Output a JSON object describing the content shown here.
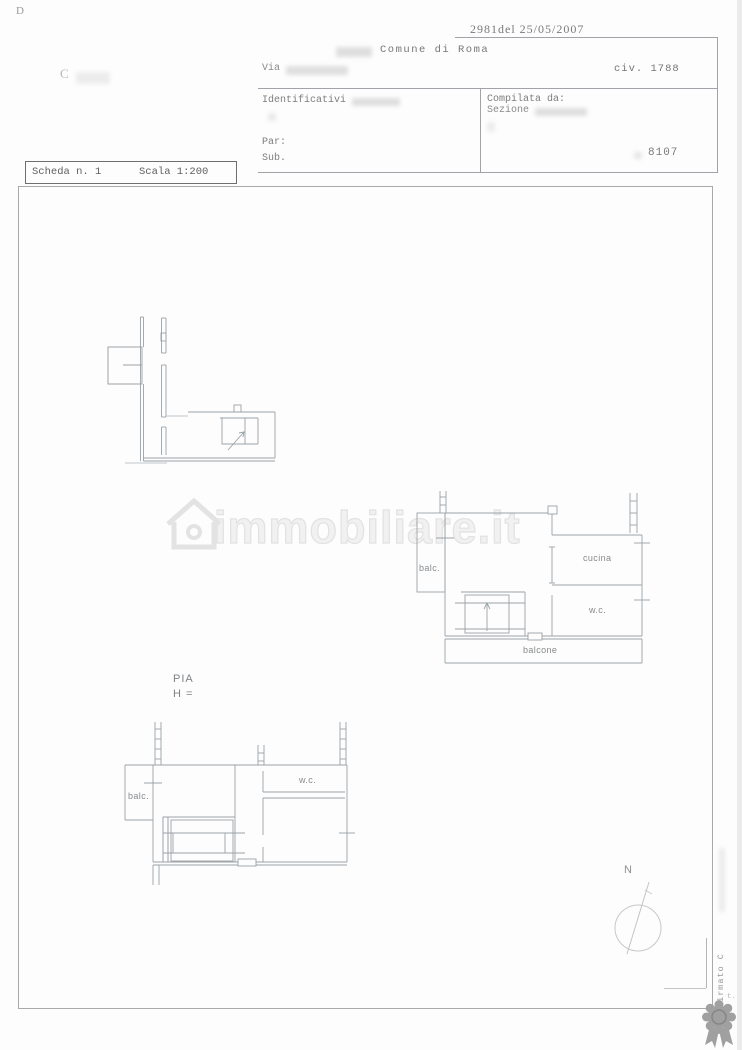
{
  "header": {
    "corner_mark": "D",
    "logo_fragment": "C",
    "protocol_number": "2981del  25/05/2007",
    "municipality": "Comune di Roma",
    "street_label": "Via",
    "civic_number": "civ. 1788",
    "identifiers_label": "Identificativi",
    "compiled_by_label": "Compilata da:",
    "section_label": "Sezione",
    "parcel_label": "Par:",
    "sub_label": "Sub.",
    "sheet_number": "8107"
  },
  "scheda": {
    "sheet_label": "Scheda n. 1",
    "scale_label": "Scala 1:200"
  },
  "plans": {
    "middle": {
      "balc": "balc.",
      "cucina": "cucina",
      "wc": "w.c.",
      "balcone": "balcone"
    },
    "lower": {
      "pia": "PIA",
      "height": "H =",
      "balc": "balc.",
      "wc": "w.c."
    },
    "compass": "N"
  },
  "watermark": {
    "brand": "immobiliare.it",
    "signature": "Firmato C",
    "fragment": "t."
  },
  "colors": {
    "plan_line": "#9aa2a8",
    "text_gray": "#6e6e6e",
    "watermark_outline": "#e2e2e2",
    "rosette_gray": "#a0a0a0"
  }
}
